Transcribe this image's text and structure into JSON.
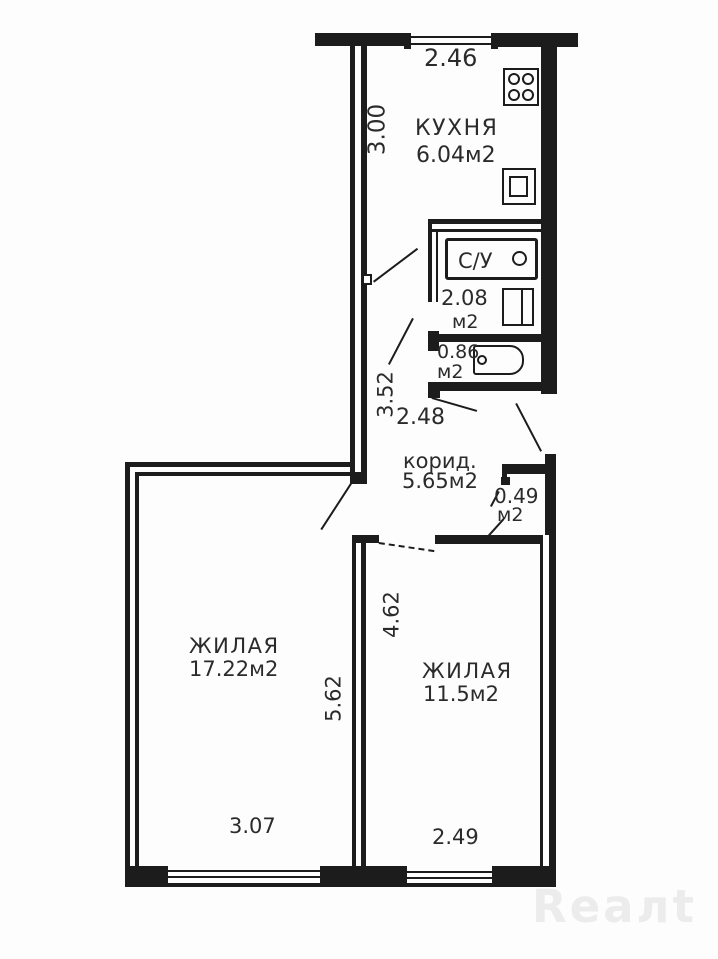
{
  "plan": {
    "kitchen": {
      "label": "КУХНЯ",
      "area": "6.04м2",
      "dim_width": "2.46",
      "dim_height": "3.00"
    },
    "bathroom": {
      "label": "С/У",
      "area": "2.08",
      "unit": "м2"
    },
    "toilet": {
      "area": "0.86",
      "unit": "м2"
    },
    "hall": {
      "dim_height": "3.52",
      "dim_width": "2.48"
    },
    "corridor": {
      "label": "корид.",
      "area": "5.65м2"
    },
    "closet": {
      "area": "0.49",
      "unit": "м2"
    },
    "living1": {
      "label": "ЖИЛАЯ",
      "area": "17.22м2",
      "dim_width": "3.07",
      "dim_height": "5.62"
    },
    "living2": {
      "label": "ЖИЛАЯ",
      "area": "11.5м2",
      "dim_width": "2.49",
      "dim_height": "4.62"
    }
  },
  "watermark": {
    "text": "Reaлt"
  },
  "colors": {
    "line": "#1c1c1c",
    "paper": "#fdfdfd",
    "watermark": "#ececec"
  }
}
